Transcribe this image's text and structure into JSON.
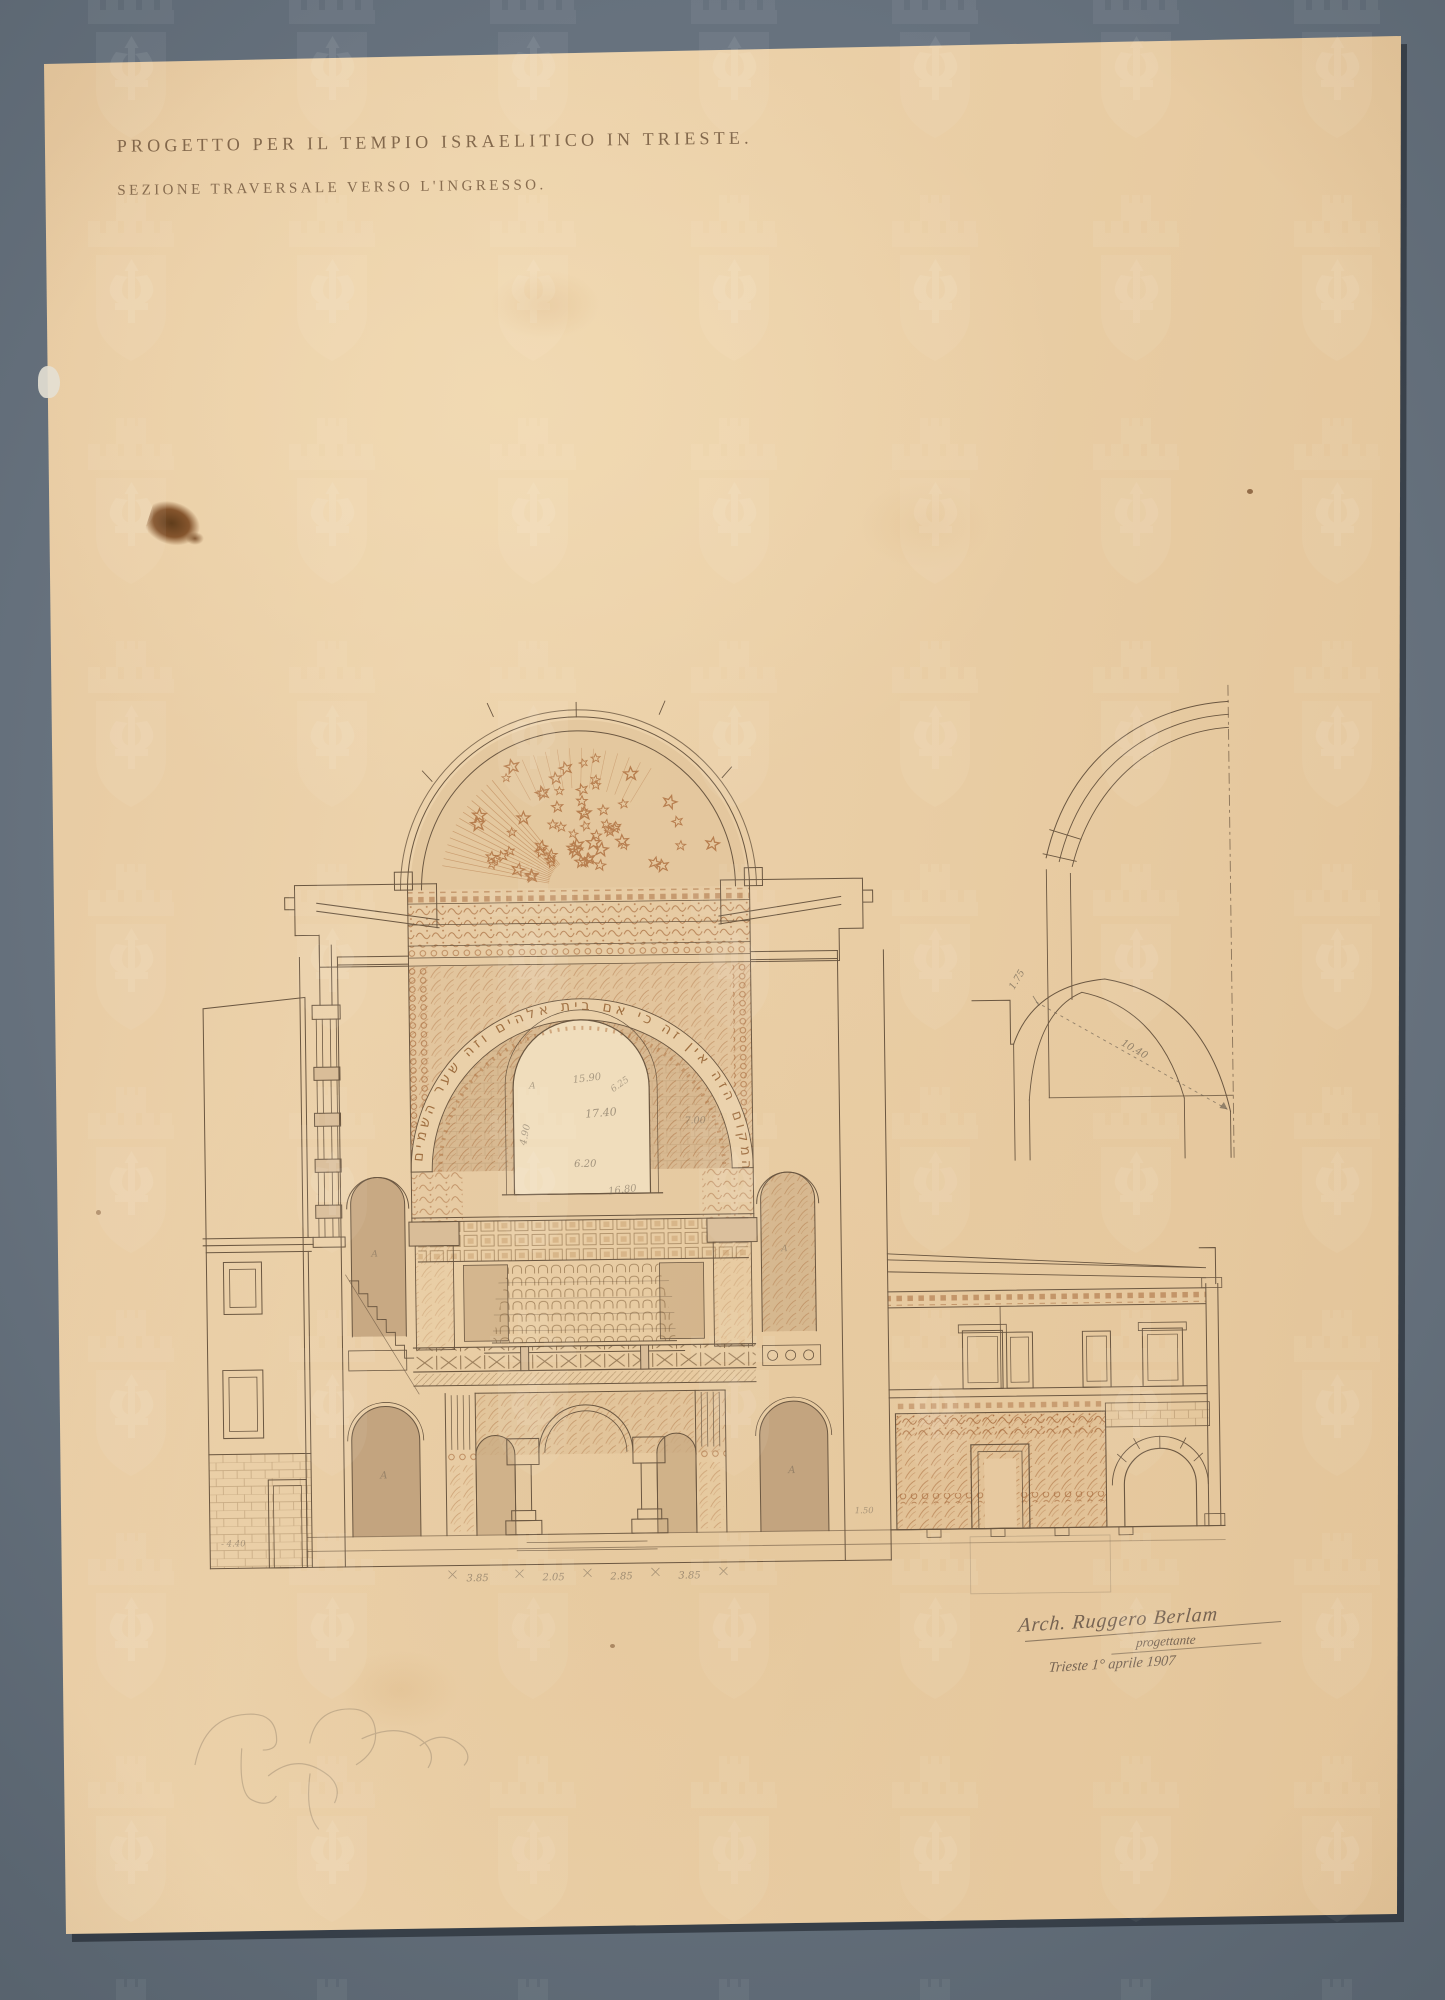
{
  "sheet": {
    "title": "PROGETTO PER IL TEMPIO ISRAELITICO IN TRIESTE.",
    "subtitle": "SEZIONE TRAVERSALE VERSO L'INGRESSO.",
    "hebrew_inscription": "מה נורא המקום הזה אין זה כי אם בית אלהים וזה שער השמים"
  },
  "signature": {
    "line1": "Arch. Ruggero Berlam",
    "line2": "progettante",
    "line3": "Trieste 1° aprile 1907"
  },
  "dimensions": {
    "detail_rise": "1.75",
    "detail_radius": "10.40",
    "floor": [
      "3.85",
      "2.05",
      "2.85",
      "3.85"
    ],
    "window": {
      "w1": "15.90",
      "w2": "17.40",
      "w3": "6.20",
      "w4": "16.80",
      "w5": "7.00",
      "w6": "4.90",
      "w7": "6.25"
    },
    "basement_level": "- 4.40",
    "annex_level": "1.50"
  },
  "labels": {
    "niche_mark": "A"
  },
  "colors": {
    "ink": "#6b5741",
    "sepia_ornament": "#a5683a",
    "pencil": "#6f6353",
    "paper": "#e9cda5",
    "mat": "#67727e",
    "wash_dark": "#bfa07b"
  }
}
